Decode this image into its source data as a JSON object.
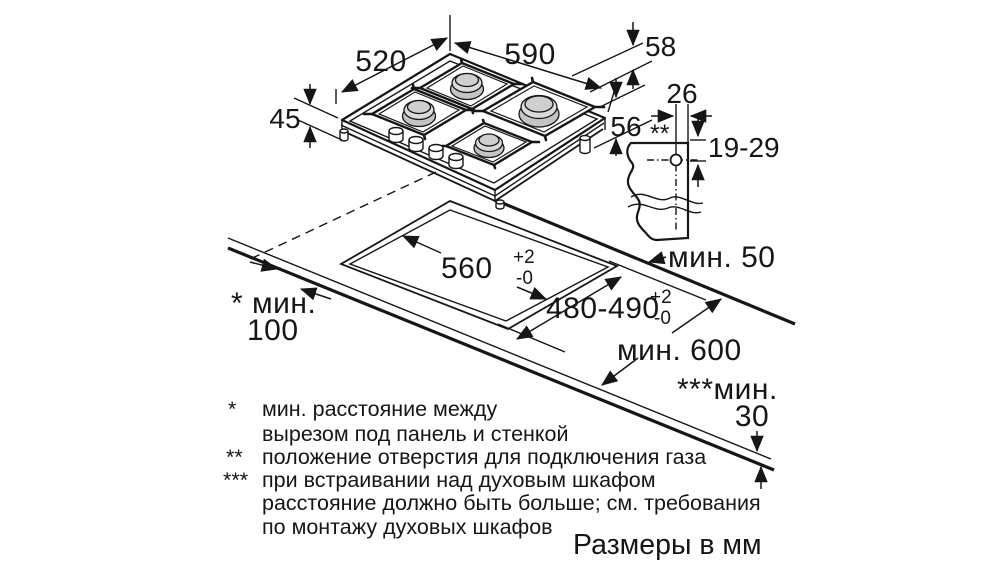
{
  "labels": {
    "hob_depth": "520",
    "hob_width": "590",
    "height_above": "58",
    "height_body": "45",
    "height_total": "56",
    "gas_offset": "26",
    "gas_hole_range": "19-29",
    "gas_marker": "**",
    "cutout_width": "560",
    "cutout_width_tol_plus": "+2",
    "cutout_width_tol_minus": "-0",
    "cutout_depth": "480-490",
    "cutout_depth_tol_plus": "+2",
    "cutout_depth_tol_minus": "-0",
    "min_back_clearance": "мин. 50",
    "min_worktop_depth": "мин. 600",
    "min_side_line1": "* мин.",
    "min_side_line2": "100",
    "min_below_line1": "***мин.",
    "min_below_line2": "30",
    "units_note": "Размеры в мм"
  },
  "footnotes": {
    "f1_marker": "*",
    "f1_line1": "мин. расстояние между",
    "f1_line2": "вырезом под панель и стенкой",
    "f2_marker": "**",
    "f2_line1": "положение отверстия для подключения газа",
    "f3_marker": "***",
    "f3_line1": "при встраивании над духовым шкафом",
    "f3_line2": "расстояние должно быть больше; см. требования",
    "f3_line3": "по монтажу духовых шкафов"
  },
  "colors": {
    "line": "#161616",
    "burner_base": "#c4c4c4",
    "burner_cap": "#dadada",
    "background": "#ffffff"
  }
}
